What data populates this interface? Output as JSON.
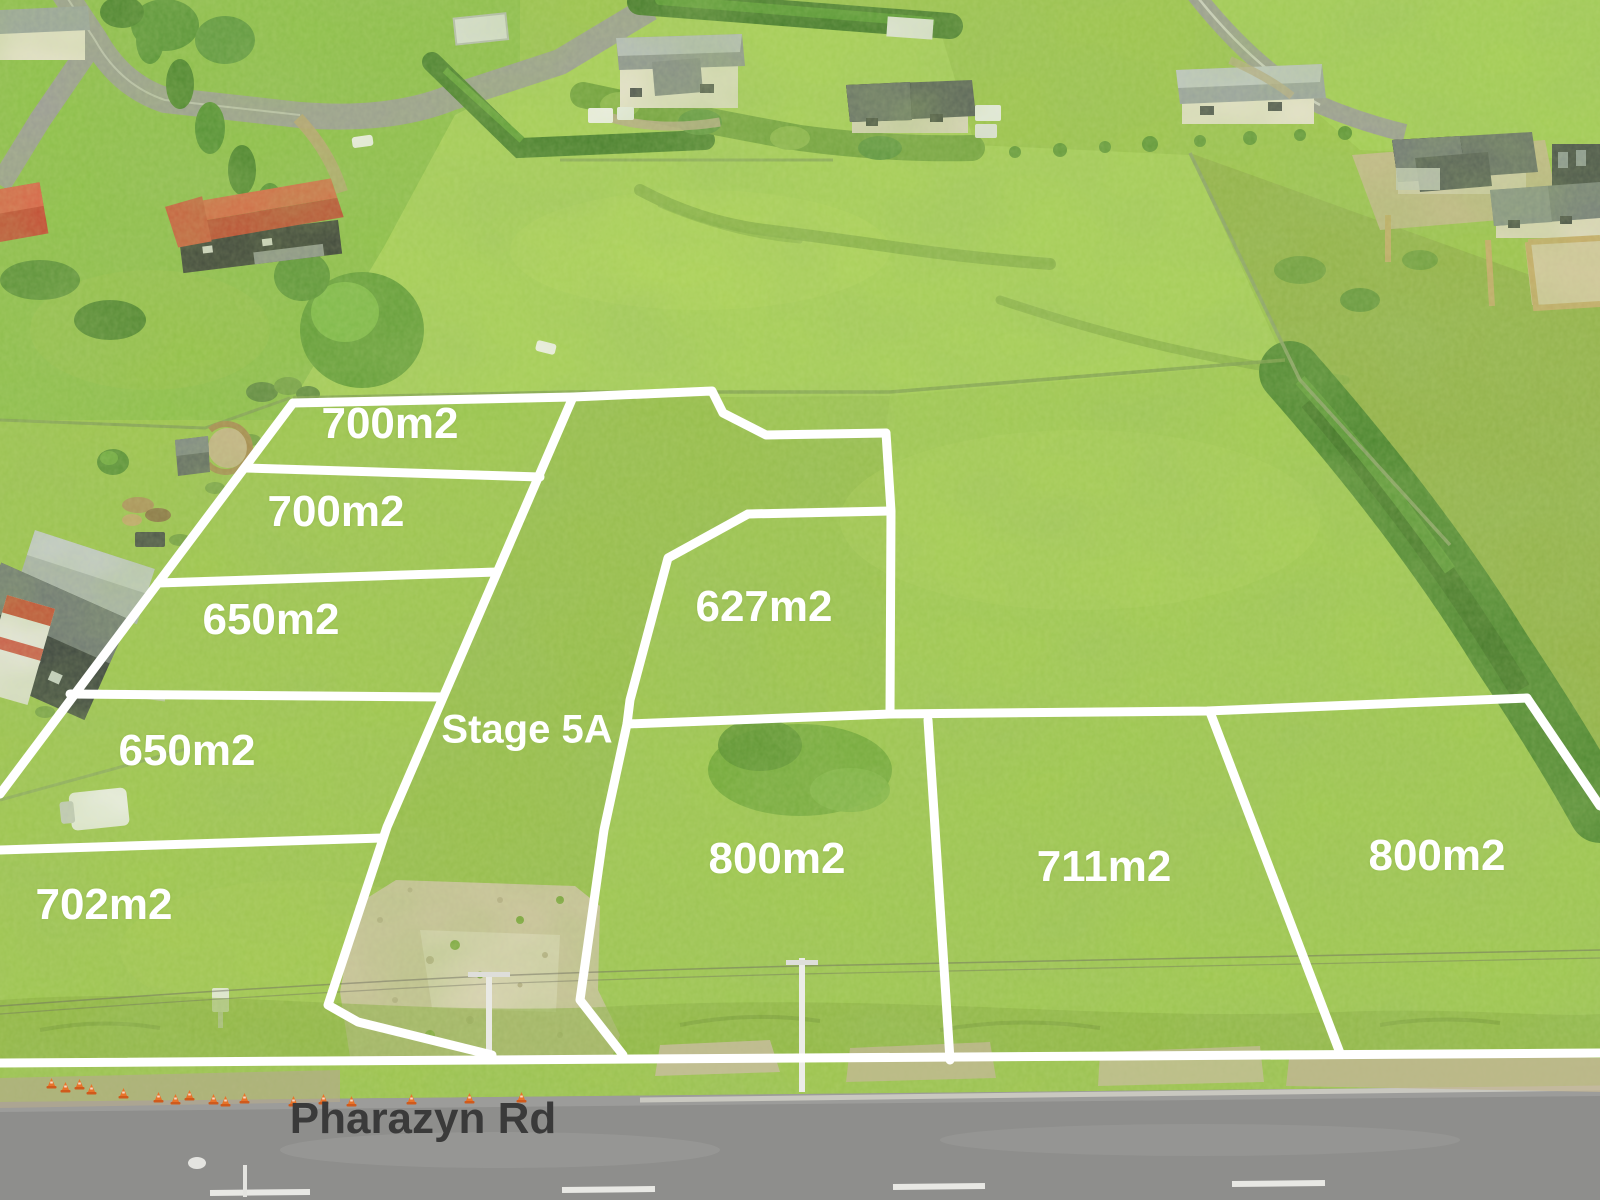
{
  "scene": {
    "description": "Aerial drone photo of rural land subdivision with marked lots",
    "road_name": "Pharazyn Rd",
    "stage_label": "Stage 5A"
  },
  "lots": [
    {
      "area": "700m2"
    },
    {
      "area": "700m2"
    },
    {
      "area": "650m2"
    },
    {
      "area": "650m2"
    },
    {
      "area": "702m2"
    },
    {
      "area": "627m2"
    },
    {
      "area": "800m2"
    },
    {
      "area": "711m2"
    },
    {
      "area": "800m2"
    }
  ],
  "colors": {
    "boundary_line": "#ffffff",
    "lot_label_text": "#ffffff",
    "road_label_text": "#3a3a3a",
    "grass": "#9cc44c",
    "road_asphalt": "#8e8e8c",
    "gravel": "#cfc3a3",
    "traffic_cone": "#e8732a",
    "hedge_dark_green": "#47822c",
    "red_roof": "#d2422f"
  }
}
